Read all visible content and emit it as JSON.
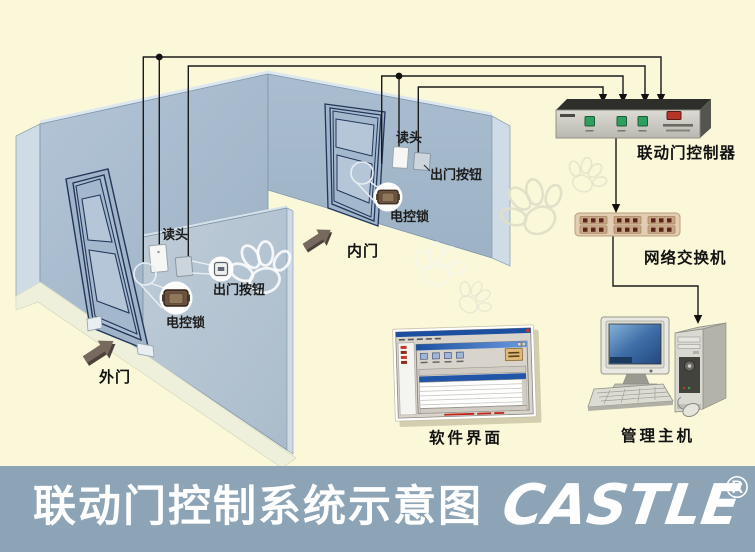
{
  "scene": {
    "outer_door": {
      "label": "外门",
      "reader_label": "读头",
      "exit_button_label": "出门按钮",
      "lock_label": "电控锁"
    },
    "inner_door": {
      "label": "内门",
      "reader_label": "读头",
      "exit_button_label": "出门按钮",
      "lock_label": "电控锁"
    },
    "controller": {
      "label": "联动门控制器"
    },
    "network_switch": {
      "label": "网络交换机"
    },
    "software": {
      "label": "软件界面"
    },
    "host": {
      "label": "管理主机"
    }
  },
  "footer": {
    "title": "联动门控制系统示意图",
    "brand": "CASTLE",
    "registered_mark": "®",
    "bar_color": "#8ca4b6"
  },
  "colors": {
    "background": "#faf8d9",
    "wall": "#a7bace",
    "partition": "#b7c6d3",
    "door_stroke": "#23365a",
    "wire": "#1a1a1a"
  }
}
